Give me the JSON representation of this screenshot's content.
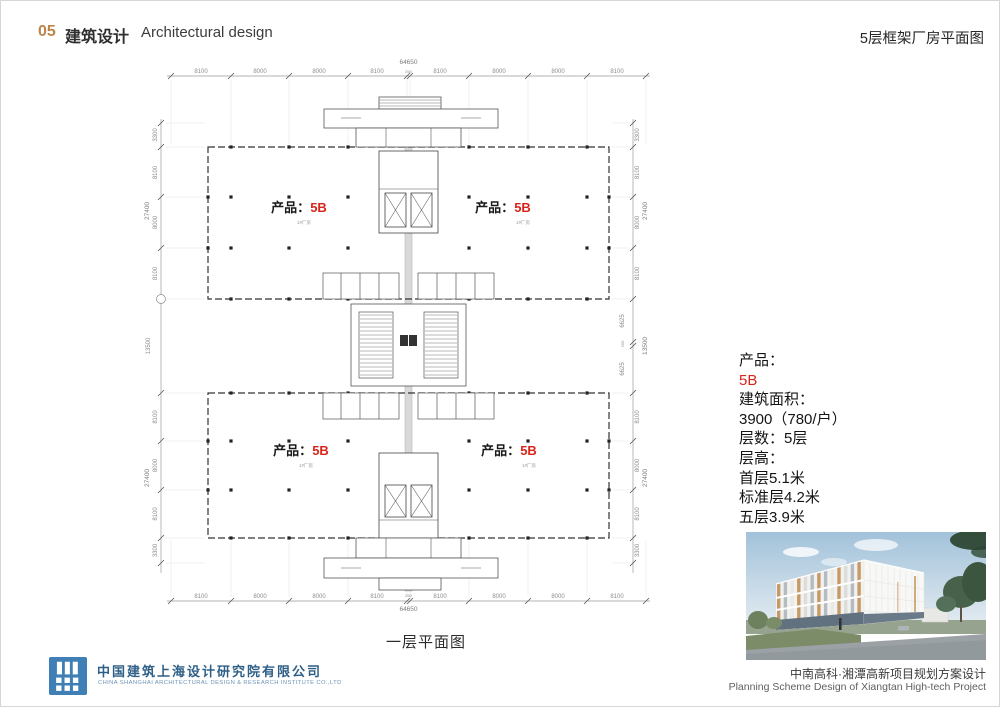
{
  "header": {
    "number": "05",
    "title_zh": "建筑设计",
    "title_en": "Architectural design",
    "right_title": "5层框架厂房平面图"
  },
  "plan": {
    "caption": "一层平面图",
    "labels": {
      "prefix": "产品：",
      "value": "5B",
      "sub": "1#厂房"
    },
    "dims": {
      "top_total": "64650",
      "top": [
        "8100",
        "8000",
        "8000",
        "8100",
        "250",
        "8100",
        "8000",
        "8000",
        "8100"
      ],
      "bottom": [
        "8100",
        "8000",
        "8000",
        "8100",
        "250",
        "8100",
        "8000",
        "8000",
        "8100"
      ],
      "bottom_total": "64650",
      "side_upper": [
        "3300",
        "8100",
        "8000",
        "8100"
      ],
      "side_lower": [
        "8100",
        "8000",
        "8100",
        "3300"
      ],
      "side_total": "27400",
      "middle_gap": "13500",
      "connector": [
        "6625",
        "250",
        "6625"
      ]
    }
  },
  "info": {
    "lines": [
      {
        "text": "产品："
      },
      {
        "text": "5B"
      },
      {
        "text": "建筑面积："
      },
      {
        "text": "3900（780/户）"
      },
      {
        "text": "层数：5层"
      },
      {
        "text": "层高："
      },
      {
        "text": "首层5.1米"
      },
      {
        "text": "标准层4.2米"
      },
      {
        "text": "五层3.9米"
      }
    ]
  },
  "project": {
    "caption_zh": "中南高科·湘潭高新项目规划方案设计",
    "caption_en": "Planning Scheme Design of Xiangtan High-tech Project"
  },
  "company": {
    "name_zh": "中国建筑上海设计研究院有限公司",
    "name_en": "CHINA SHANGHAI ARCHITECTURAL DESIGN & RESEARCH INSTITUTE CO.,LTD"
  },
  "colors": {
    "accent_red": "#d8251c",
    "header_orange": "#b9854a",
    "company_blue": "#2e5f87",
    "logo_blue": "#3f7fb5"
  }
}
